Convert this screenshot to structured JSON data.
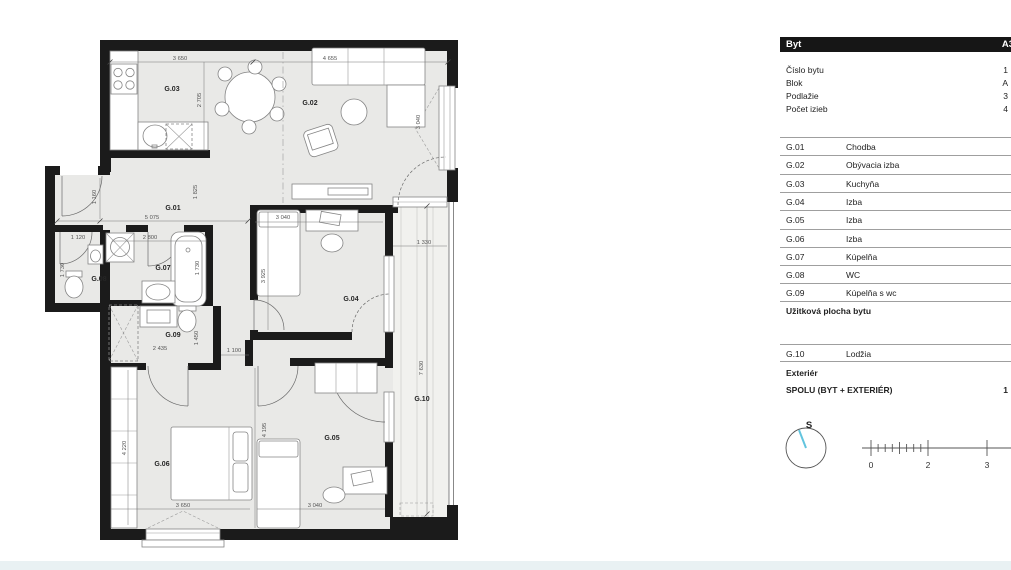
{
  "colors": {
    "wall": "#1b1b1b",
    "floor": "#e9e9e7",
    "compass_needle": "#62c4de"
  },
  "plan": {
    "labels": {
      "g01": "G.01",
      "g02": "G.02",
      "g03": "G.03",
      "g04": "G.04",
      "g05": "G.05",
      "g06": "G.06",
      "g07": "G.07",
      "g08": "G.08",
      "g09": "G.09",
      "g10": "G.10"
    },
    "dims": {
      "d1": "3 650",
      "d2": "4 655",
      "d3": "2 705",
      "d4": "1 160",
      "d5": "5 075",
      "d6": "1 825",
      "d7": "1 120",
      "d8": "2 800",
      "d9": "1 730",
      "d10": "1 730",
      "d11": "2 435",
      "d12": "1 450",
      "d13": "1 100",
      "d14": "3 040",
      "d15": "3 925",
      "d16": "3 040",
      "d17": "1 330",
      "d18": "7 630",
      "d19": "4 220",
      "d20": "3 650",
      "d21": "4 195",
      "d22": "3 040"
    }
  },
  "panel": {
    "header": {
      "title": "Byt",
      "code": "A3"
    },
    "info": [
      {
        "label": "Číslo bytu",
        "value": "1"
      },
      {
        "label": "Blok",
        "value": "A"
      },
      {
        "label": "Podlažie",
        "value": "3"
      },
      {
        "label": "Počet izieb",
        "value": "4"
      }
    ],
    "rooms": [
      {
        "code": "G.01",
        "name": "Chodba"
      },
      {
        "code": "G.02",
        "name": "Obývacia izba"
      },
      {
        "code": "G.03",
        "name": "Kuchyňa"
      },
      {
        "code": "G.04",
        "name": "Izba"
      },
      {
        "code": "G.05",
        "name": "Izba"
      },
      {
        "code": "G.06",
        "name": "Izba"
      },
      {
        "code": "G.07",
        "name": "Kúpelňa"
      },
      {
        "code": "G.08",
        "name": "WC"
      },
      {
        "code": "G.09",
        "name": "Kúpelňa s wc"
      }
    ],
    "subtotal_label": "Užitková plocha bytu",
    "exterior": {
      "rooms": [
        {
          "code": "G.10",
          "name": "Lodžia"
        }
      ],
      "section_label": "Exteriér",
      "total_label": "SPOLU (BYT + EXTERIÉR)",
      "total_value": "1"
    },
    "compass": {
      "north_label": "S"
    },
    "scale": {
      "tick0": "0",
      "tick2": "2",
      "tick3": "3"
    }
  }
}
